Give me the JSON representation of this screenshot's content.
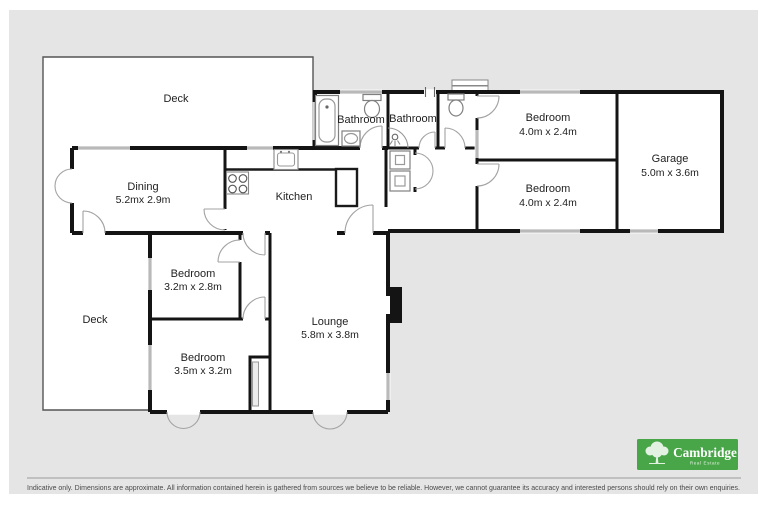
{
  "colors": {
    "canvas_bg": "#e5e5e6",
    "logo_green": "#48a548",
    "wall": "#141414"
  },
  "floorplan": {
    "rooms": {
      "deck_top": {
        "label": "Deck"
      },
      "dining": {
        "label": "Dining",
        "dims": "5.2mx 2.9m"
      },
      "kitchen": {
        "label": "Kitchen"
      },
      "bathroom_1": {
        "label": "Bathroom"
      },
      "bathroom_2": {
        "label": "Bathroom"
      },
      "bedroom_top_right": {
        "label": "Bedroom",
        "dims": "4.0m x 2.4m"
      },
      "bedroom_mid_right": {
        "label": "Bedroom",
        "dims": "4.0m x 2.4m"
      },
      "garage": {
        "label": "Garage",
        "dims": "5.0m x 3.6m"
      },
      "deck_left": {
        "label": "Deck"
      },
      "bedroom_small": {
        "label": "Bedroom",
        "dims": "3.2m x 2.8m"
      },
      "bedroom_large": {
        "label": "Bedroom",
        "dims": "3.5m x 3.2m"
      },
      "lounge": {
        "label": "Lounge",
        "dims": "5.8m x 3.8m"
      }
    }
  },
  "footer": {
    "disclaimer": "Indicative only. Dimensions are approximate. All information contained herein is gathered from sources we believe to be reliable. However, we cannot guarantee its accuracy and interested persons should rely on their own enquiries."
  },
  "logo": {
    "brand": "Cambridge",
    "tagline": "Real Estate"
  }
}
